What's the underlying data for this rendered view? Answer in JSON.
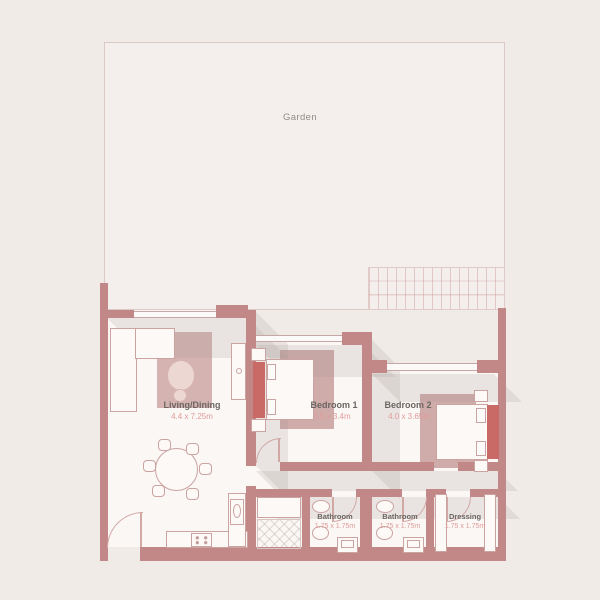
{
  "title": "Apartment floor plan with garden",
  "colors": {
    "background": "#f1ebe8",
    "wall": "#c28787",
    "headboard_accent": "#ca6a67",
    "rug": "#cfaba9",
    "room_label": "#6b6662",
    "dimension_label": "#e09b99",
    "garden_label": "#918c88",
    "floor": "#faf7f5"
  },
  "garden": {
    "label": "Garden"
  },
  "rooms": [
    {
      "name": "Living/Dining",
      "dims": "4.4 x 7.25m"
    },
    {
      "name": "Bedroom 1",
      "dims": "3.5 x 3.4m"
    },
    {
      "name": "Bedroom 2",
      "dims": "4.0 x 3.65m"
    },
    {
      "name": "Bathroom",
      "dims": "1.75 x 1.75m"
    },
    {
      "name": "Bathroom",
      "dims": "1.75 x 1.75m"
    },
    {
      "name": "Dressing",
      "dims": "1.75 x 1.75m"
    }
  ]
}
